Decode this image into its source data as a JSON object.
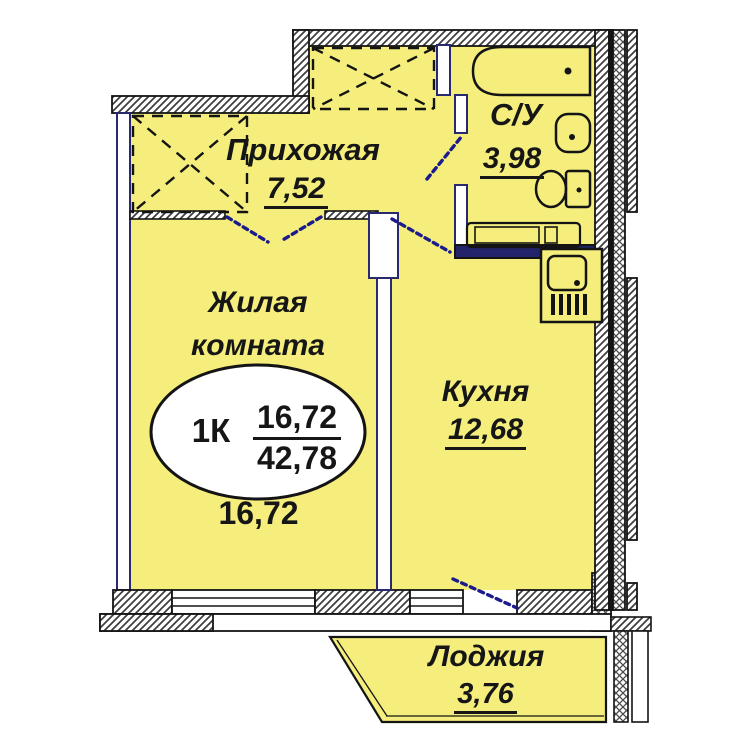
{
  "colors": {
    "room_fill": "#f5ee7d",
    "wall_dark": "#141414",
    "door_blue": "#1b1b8e",
    "thin_wall_stroke": "#29296e"
  },
  "rooms": {
    "hallway": {
      "name": "Прихожая",
      "area": "7,52"
    },
    "bathroom": {
      "name": "С/У",
      "area": "3,98"
    },
    "living_room": {
      "name_line1": "Жилая",
      "name_line2": "комната",
      "area": "16,72"
    },
    "kitchen": {
      "name": "Кухня",
      "area": "12,68"
    },
    "loggia": {
      "name": "Лоджия",
      "area": "3,76"
    }
  },
  "apartment_badge": {
    "type": "1К",
    "living_area": "16,72",
    "total_area": "42,78"
  },
  "fixtures": [
    "bathtub",
    "bathroom-sink",
    "toilet",
    "washing-machine",
    "kitchen-sink-unit",
    "wardrobe-left",
    "wardrobe-top"
  ]
}
